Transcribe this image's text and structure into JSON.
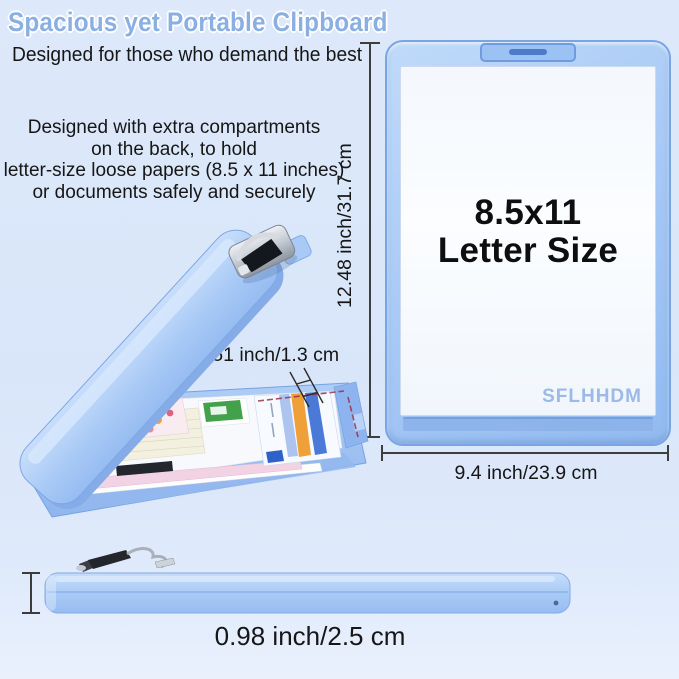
{
  "header": {
    "title": "Spacious yet Portable Clipboard",
    "subtitle": "Designed for those who demand the best",
    "description": "Designed with extra compartments\non the back, to hold\nletter-size loose papers (8.5 x 11 inches)\nor documents safely and securely"
  },
  "front_view": {
    "size_line1": "8.5x11",
    "size_line2": "Letter Size",
    "brand": "SFLHHDM"
  },
  "dimensions": {
    "height": "12.48 inch/31.7 cm",
    "width": "9.4 inch/23.9 cm",
    "edge": "0.51 inch/1.3 cm",
    "thickness": "0.98 inch/2.5 cm"
  },
  "colors": {
    "background": "#dde9fa",
    "clipboard_blue": "#a7c9f5",
    "clipboard_border": "#78a5e4",
    "title_blue": "#8aafe2",
    "brand_blue": "#9cb9e8",
    "dimension_line": "#3e3e3e",
    "text_black": "#161616"
  }
}
